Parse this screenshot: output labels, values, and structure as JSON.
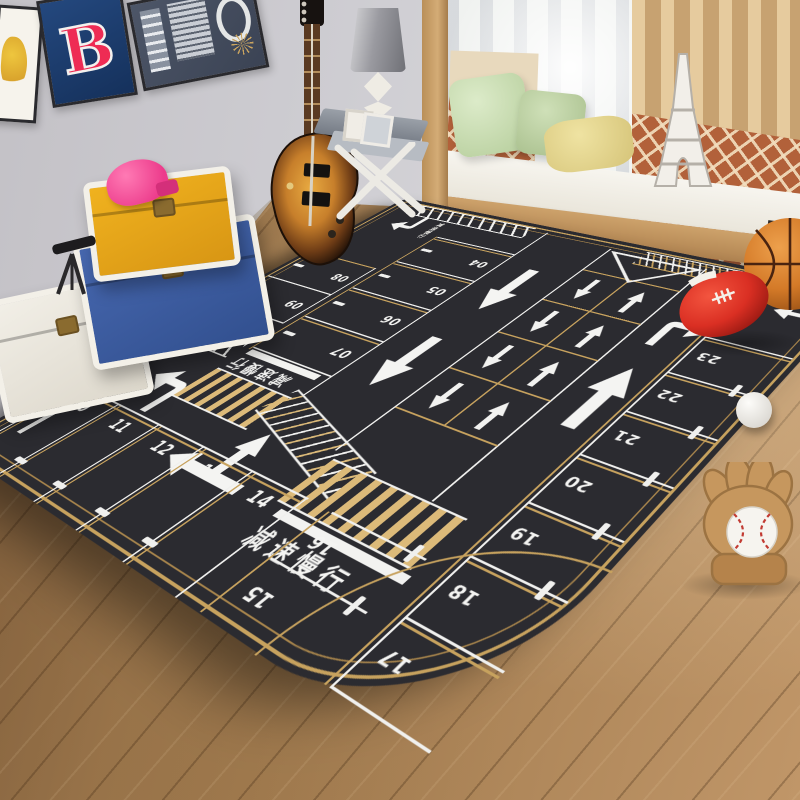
{
  "room": {
    "description": "kids bedroom with parking-lot play mat rug, wall posters, toy trunks, guitar, window nook",
    "posters": {
      "team_letter": "B"
    }
  },
  "rug": {
    "slow_text_center": "减速慢行",
    "slow_text_upper": "减速慢行",
    "slow_text_left_edge": "减速慢行",
    "slow_text_entry": "减速慢行",
    "slow_text_corner": "减速慢行",
    "stalls": {
      "left_block": [
        "08",
        "09"
      ],
      "mid_block": [
        "04",
        "05",
        "06",
        "07"
      ],
      "bottom_left_block": [
        "10",
        "11",
        "12",
        "13",
        "14"
      ],
      "bottom_right_block": [
        "16",
        "15"
      ],
      "right_column": [
        "23",
        "22",
        "21",
        "20",
        "19",
        "18",
        "17"
      ]
    },
    "colors": {
      "base": "#2b2b30",
      "gold": "#c7a25e",
      "marking_white": "#f3f3f1",
      "zebra_gold": "#dcba79"
    }
  },
  "toys": {
    "items": [
      "basketball",
      "toy-football",
      "white-ball",
      "baseball-glove",
      "baseball",
      "pink-toy",
      "telescope"
    ],
    "trunk_colors": {
      "top": "#e8a91c",
      "middle": "#3d5fa5",
      "bottom": "#ece8df"
    }
  }
}
